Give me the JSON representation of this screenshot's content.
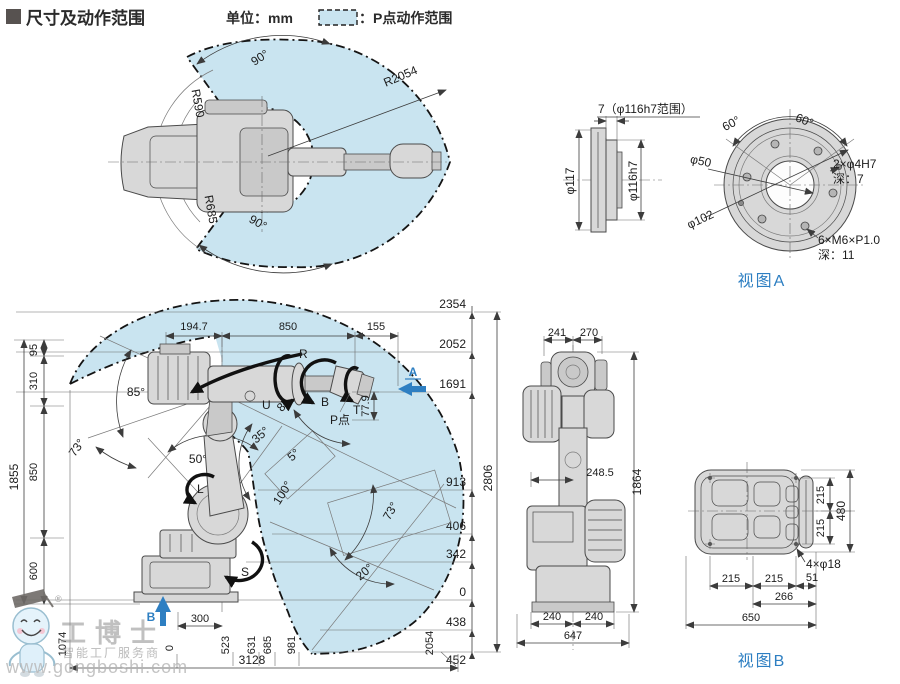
{
  "header": {
    "title": "尺寸及动作范围",
    "unit": "单位：mm",
    "legend": "：P点动作范围"
  },
  "colors": {
    "range_fill": "#c9e4f0",
    "accent_blue": "#2e7fc2",
    "robot_gray": "#d8d8d8",
    "line_dark": "#3c3c3c"
  },
  "top_view": {
    "angle_top": "90°",
    "angle_bottom": "90°",
    "r_outer": "R2054",
    "r_inner_top": "R590",
    "r_inner_bottom": "R685"
  },
  "flange_side": {
    "note": "7（φ116h7范围）",
    "dia_outer": "φ117",
    "dia_fit": "φ116h7"
  },
  "flange_front": {
    "angle_left": "60°",
    "angle_right": "60°",
    "dia_pilot": "φ50",
    "dia_bolt_circle": "φ102",
    "pin_holes": "2×φ4H7",
    "pin_depth": "深：7",
    "tap_holes": "6×M6×P1.0",
    "tap_depth": "深：11",
    "view_label": "视图A"
  },
  "side_view": {
    "top_dims": [
      "194.7",
      "850",
      "155"
    ],
    "left_dims": [
      "95",
      "310",
      "850",
      "600"
    ],
    "left_overall": "1855",
    "levels": [
      "2354",
      "2052",
      "1691",
      "913",
      "406",
      "342",
      "0",
      "438",
      "452"
    ],
    "overall_height": "2806",
    "positions": [
      "1074",
      "0",
      "523",
      "631",
      "685",
      "981",
      "2054"
    ],
    "overall_width": "3128",
    "dim_300": "300",
    "dim_779": "77.9",
    "p_point": "P点",
    "axes": {
      "s": "S",
      "l": "L",
      "u": "U",
      "r": "R",
      "b": "B",
      "t": "T"
    },
    "angles": {
      "a85": "85°",
      "a73_left": "73°",
      "a50": "50°",
      "a35": "35°",
      "a5": "5°",
      "a100": "100°",
      "a73_right": "73°",
      "a20": "20°",
      "a85_wrist": "85°"
    },
    "view_a_arrow": "A",
    "view_b_arrow": "B"
  },
  "front_view": {
    "d241": "241",
    "d270": "270",
    "d2485": "248.5",
    "d1864": "1864",
    "d240a": "240",
    "d240b": "240",
    "d647": "647"
  },
  "base_view": {
    "d215a": "215",
    "d215b": "215",
    "d480": "480",
    "holes_note": "4×φ18",
    "d215c": "215",
    "d215d": "215",
    "d51": "51",
    "d266": "266",
    "d650": "650",
    "view_label": "视图B"
  },
  "watermark": {
    "reg": "®",
    "brand": "工博士",
    "tagline": "智能工厂服务商",
    "url": "www.gongboshi.com"
  }
}
